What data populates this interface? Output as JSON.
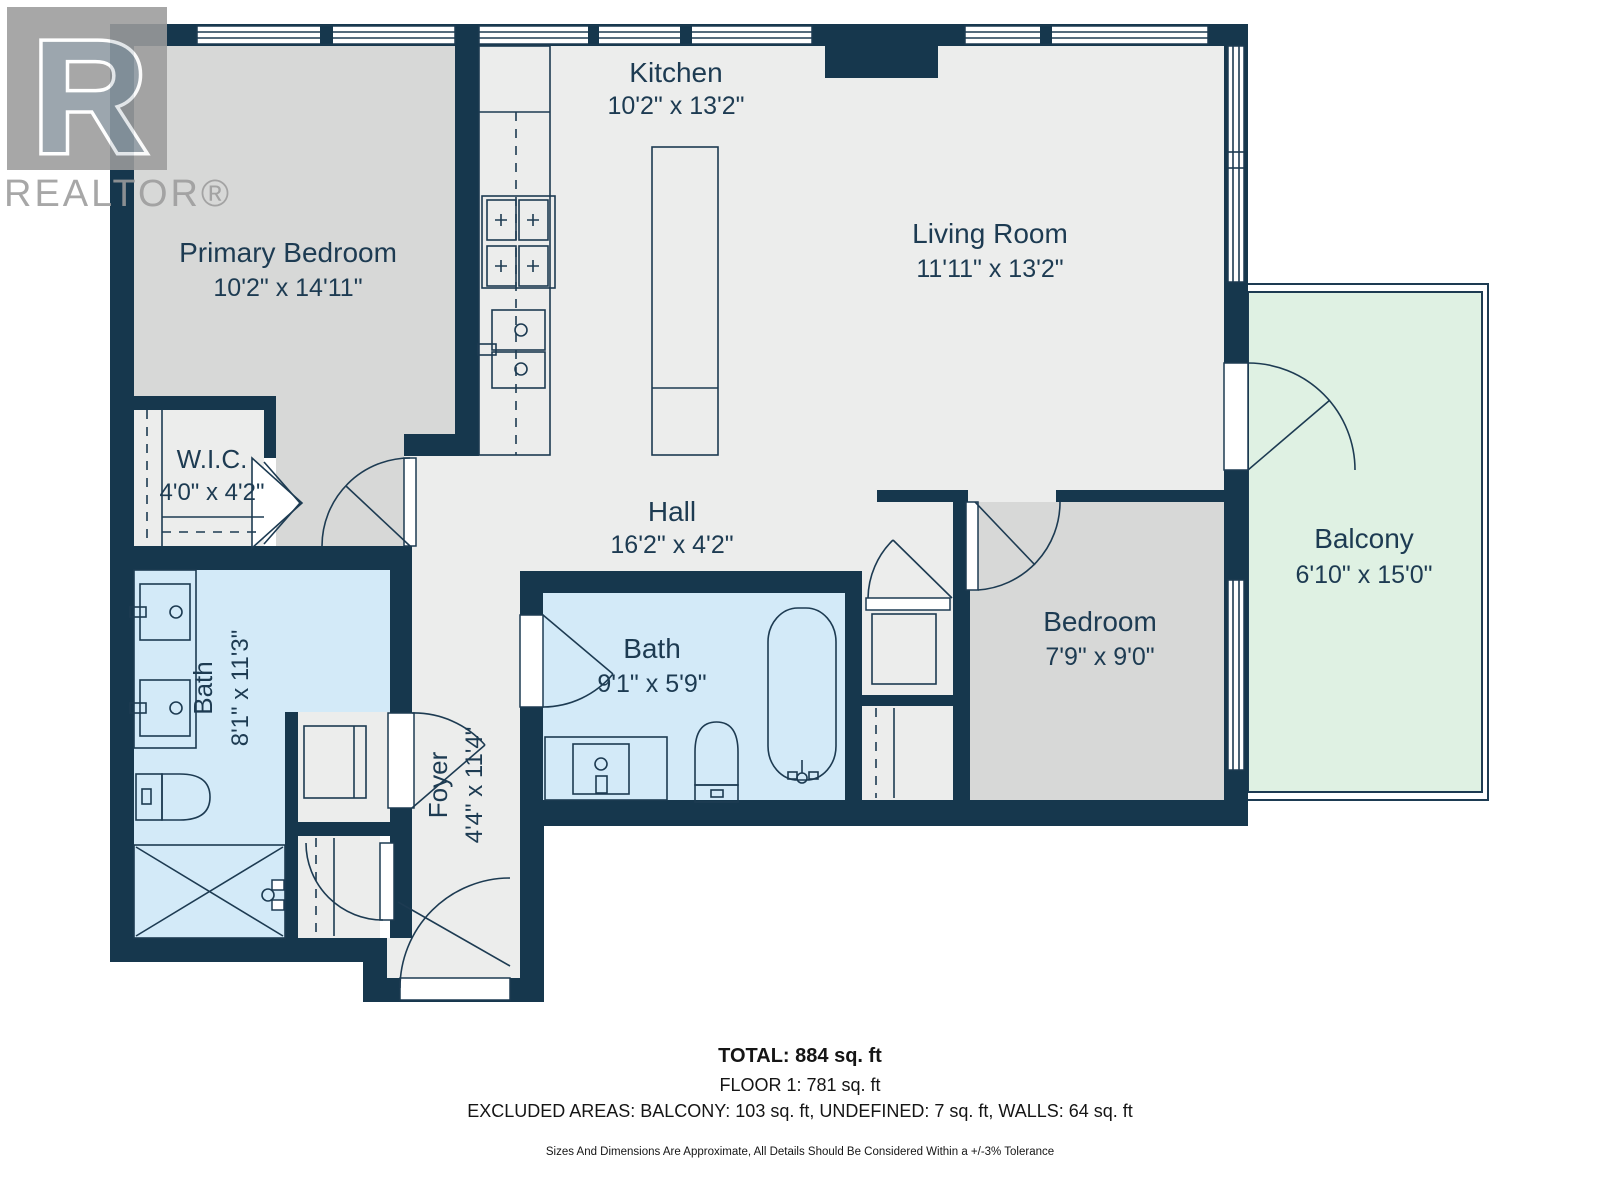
{
  "branding": {
    "logo_letter": "R",
    "logo_wordmark": "REALTOR®"
  },
  "rooms": {
    "kitchen": {
      "name": "Kitchen",
      "dimensions": "10'2\" x 13'2\""
    },
    "living_room": {
      "name": "Living Room",
      "dimensions": "11'11\" x 13'2\""
    },
    "primary_bedroom": {
      "name": "Primary Bedroom",
      "dimensions": "10'2\" x 14'11\""
    },
    "wic": {
      "name": "W.I.C.",
      "dimensions": "4'0\" x 4'2\""
    },
    "hall": {
      "name": "Hall",
      "dimensions": "16'2\" x 4'2\""
    },
    "balcony": {
      "name": "Balcony",
      "dimensions": "6'10\" x 15'0\""
    },
    "bedroom": {
      "name": "Bedroom",
      "dimensions": "7'9\" x 9'0\""
    },
    "bath_main": {
      "name": "Bath",
      "dimensions": "8'1\" x 11'3\""
    },
    "bath_second": {
      "name": "Bath",
      "dimensions": "9'1\" x 5'9\""
    },
    "foyer": {
      "name": "Foyer",
      "dimensions": "4'4\" x 11'4\""
    }
  },
  "summary": {
    "total": "TOTAL: 884 sq. ft",
    "floor": "FLOOR 1: 781 sq. ft",
    "excluded_areas": "EXCLUDED AREAS: BALCONY: 103 sq. ft, UNDEFINED: 7 sq. ft, WALLS: 64 sq. ft",
    "disclaimer": "Sizes And Dimensions Are Approximate, All Details Should Be Considered Within a +/-3% Tolerance"
  },
  "colors": {
    "wall": "#16374d",
    "floor_light": "#ecedec",
    "room_gray": "#d7d8d7",
    "bath_blue": "#d3eaf8",
    "balcony_green": "#dff1e3",
    "label": "#1d3b52",
    "footer": "#151515",
    "logo": "#9c9c9c"
  }
}
